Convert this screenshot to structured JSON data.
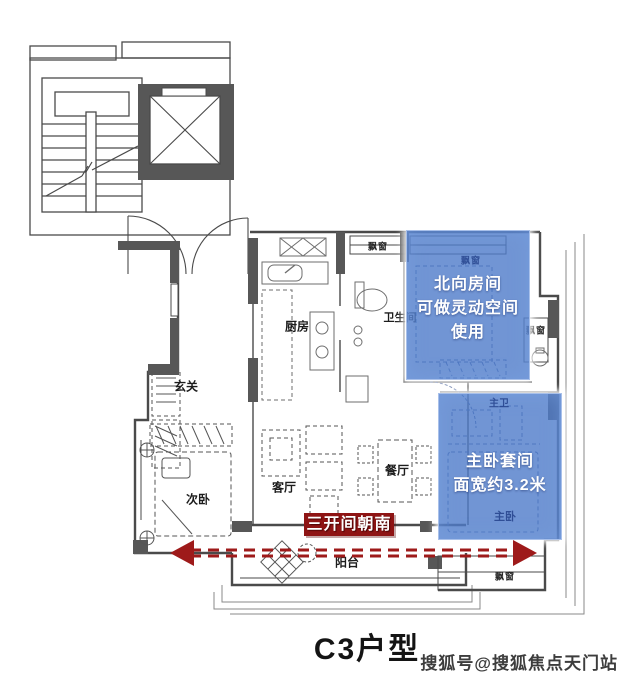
{
  "title": "C3户型",
  "watermark": "搜狐号@搜狐焦点天门站",
  "overlays": {
    "north_room_note": {
      "line1": "北向房间",
      "line2": "可做灵动空间",
      "line3": "使用"
    },
    "master_note": {
      "line1": "主卧套间",
      "line2": "面宽约3.2米"
    },
    "banner_label": "三开间朝南"
  },
  "rooms": {
    "entry": "玄关",
    "kitchen": "厨房",
    "bathroom": "卫生间",
    "second_bedroom": "次卧",
    "living_room": "客厅",
    "dining_room": "餐厅",
    "balcony": "阳台",
    "master_bath": "主卫",
    "master_bedroom": "主卧",
    "bay_window": "飘窗"
  },
  "colors": {
    "overlay_blue": "#4d7ac9",
    "banner_red": "#8e1414",
    "arrow_red": "#9e1a1a",
    "wall_gray": "#575757"
  }
}
